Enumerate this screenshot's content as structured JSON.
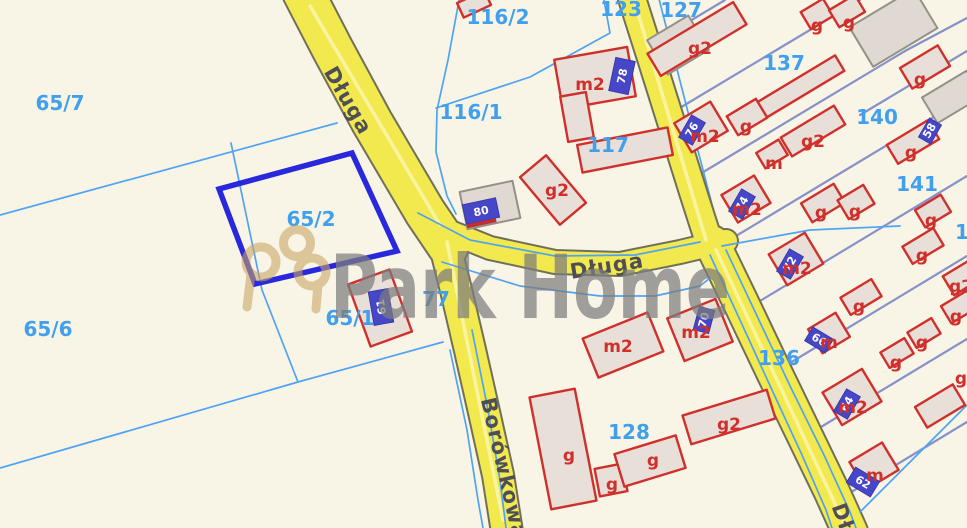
{
  "watermark": {
    "text": "Park Home"
  },
  "highlight": {
    "parcel": "65/2"
  },
  "streets": [
    {
      "name": "Długa"
    },
    {
      "name": "Długa"
    },
    {
      "name": "Borówkowa"
    },
    {
      "name": "Dł"
    }
  ],
  "parcels": [
    {
      "label": "65/7"
    },
    {
      "label": "65/2"
    },
    {
      "label": "65/6"
    },
    {
      "label": "65/1"
    },
    {
      "label": "116/1"
    },
    {
      "label": "116/2"
    },
    {
      "label": "123"
    },
    {
      "label": "127"
    },
    {
      "label": "137"
    },
    {
      "label": "140"
    },
    {
      "label": "141"
    },
    {
      "label": "117"
    },
    {
      "label": "128"
    },
    {
      "label": "136"
    },
    {
      "label": "77"
    },
    {
      "label": "1"
    }
  ],
  "building_labels": [
    {
      "label": "m2"
    },
    {
      "label": "g2"
    },
    {
      "label": "g2"
    },
    {
      "label": "g"
    },
    {
      "label": "g"
    },
    {
      "label": "g"
    },
    {
      "label": "g"
    },
    {
      "label": "g2"
    },
    {
      "label": "m"
    },
    {
      "label": "g"
    },
    {
      "label": "m2"
    },
    {
      "label": "m2"
    },
    {
      "label": "g"
    },
    {
      "label": "g"
    },
    {
      "label": "g"
    },
    {
      "label": "g"
    },
    {
      "label": "g2"
    },
    {
      "label": "m2"
    },
    {
      "label": "g"
    },
    {
      "label": "g"
    },
    {
      "label": "m"
    },
    {
      "label": "g"
    },
    {
      "label": "g"
    },
    {
      "label": "m2"
    },
    {
      "label": "m2"
    },
    {
      "label": "m2"
    },
    {
      "label": "m"
    },
    {
      "label": "g"
    },
    {
      "label": "g"
    },
    {
      "label": "g"
    },
    {
      "label": "g2"
    },
    {
      "label": "g"
    }
  ],
  "markers": [
    {
      "number": "80"
    },
    {
      "number": "78"
    },
    {
      "number": "61"
    },
    {
      "number": "76"
    },
    {
      "number": "74"
    },
    {
      "number": "72"
    },
    {
      "number": "70"
    },
    {
      "number": "66"
    },
    {
      "number": "64"
    },
    {
      "number": "62"
    },
    {
      "number": "58"
    }
  ],
  "colors": {
    "background": "#F8F4E6",
    "parcel_line": "#4FA3F2",
    "boundary_line": "#8691C9",
    "road_fill": "#F2E94E",
    "building_stroke": "#D0302C",
    "highlight_stroke": "#2828DC",
    "marker_blue": "#4646C8",
    "parcel_label_blue": "#41A0EE",
    "watermark_gray": "#7D7D7D",
    "logo_gold": "#C9A562"
  }
}
